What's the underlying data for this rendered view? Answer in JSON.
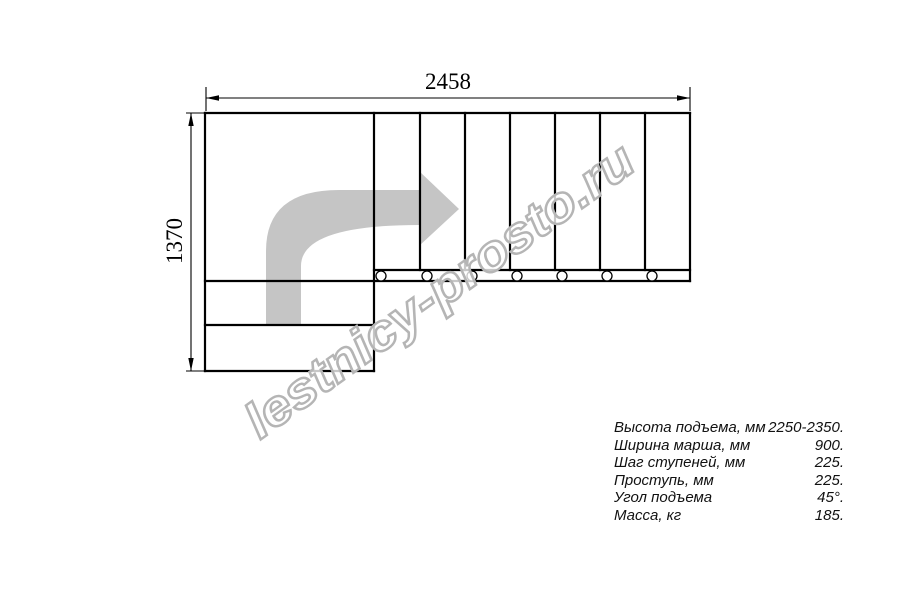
{
  "drawing": {
    "top_dimension": "2458",
    "left_dimension": "1370",
    "watermark": "lestnicy-prosto.ru",
    "colors": {
      "line": "#000000",
      "arrow_fill": "#c5c5c5",
      "watermark_stroke": "#b5b5b5",
      "text": "#111111"
    }
  },
  "specs": {
    "rows": [
      {
        "label": "Высота подъема, мм",
        "value": "2250-2350."
      },
      {
        "label": "Ширина марша, мм",
        "value": "900."
      },
      {
        "label": "Шаг ступеней, мм",
        "value": "225."
      },
      {
        "label": "Проступь, мм",
        "value": "225."
      },
      {
        "label": "Угол подъема",
        "value": "45°."
      },
      {
        "label": "Масса, кг",
        "value": "185."
      }
    ]
  }
}
